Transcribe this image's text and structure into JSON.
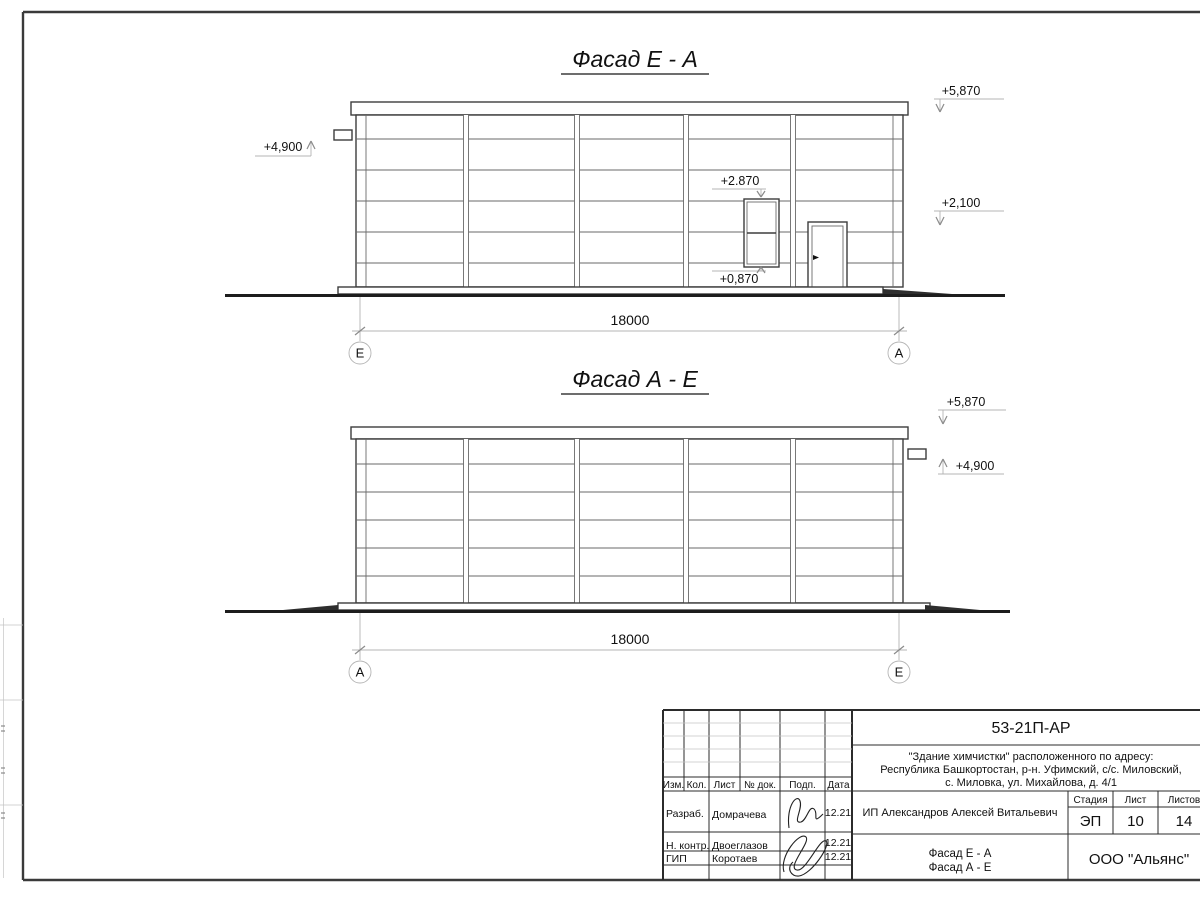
{
  "facade1": {
    "title": "Фасад Е - А",
    "dim": "18000",
    "axis_left": "Е",
    "axis_right": "А",
    "level_top": "+5,870",
    "level_mid": "+2,100",
    "level_left": "+4,900",
    "level_window_top": "+2.870",
    "level_window_bottom": "+0,870"
  },
  "facade2": {
    "title": "Фасад А - Е",
    "dim": "18000",
    "axis_left": "А",
    "axis_right": "Е",
    "level_top": "+5,870",
    "level_right": "+4,900"
  },
  "title_block": {
    "code": "53-21П-АР",
    "project_lines": [
      "\"Здание химчистки\" расположенного по адресу:",
      "Республика Башкортостан, р-н. Уфимский, с/с. Миловский,",
      "с. Миловка, ул. Михайлова, д. 4/1"
    ],
    "client": "ИП Александров Алексей Витальевич",
    "content": [
      "Фасад Е - А",
      "Фасад А - Е"
    ],
    "organization": "ООО \"Альянс\"",
    "columns": {
      "izm": "Изм.",
      "kol": "Кол.",
      "list": "Лист",
      "doc": "№ док.",
      "podp": "Подп.",
      "date": "Дата"
    },
    "stage_label": "Стадия",
    "list_label": "Лист",
    "listov_label": "Листов",
    "stage": "ЭП",
    "sheet": "10",
    "sheets": "14",
    "rows": [
      {
        "role": "Разраб.",
        "name": "Домрачева",
        "date": "12.21"
      },
      {
        "role": "Н. контр.",
        "name": "Двоеглазов",
        "date": "12.21"
      },
      {
        "role": "ГИП",
        "name": "Коротаев",
        "date": "12.21"
      }
    ]
  }
}
